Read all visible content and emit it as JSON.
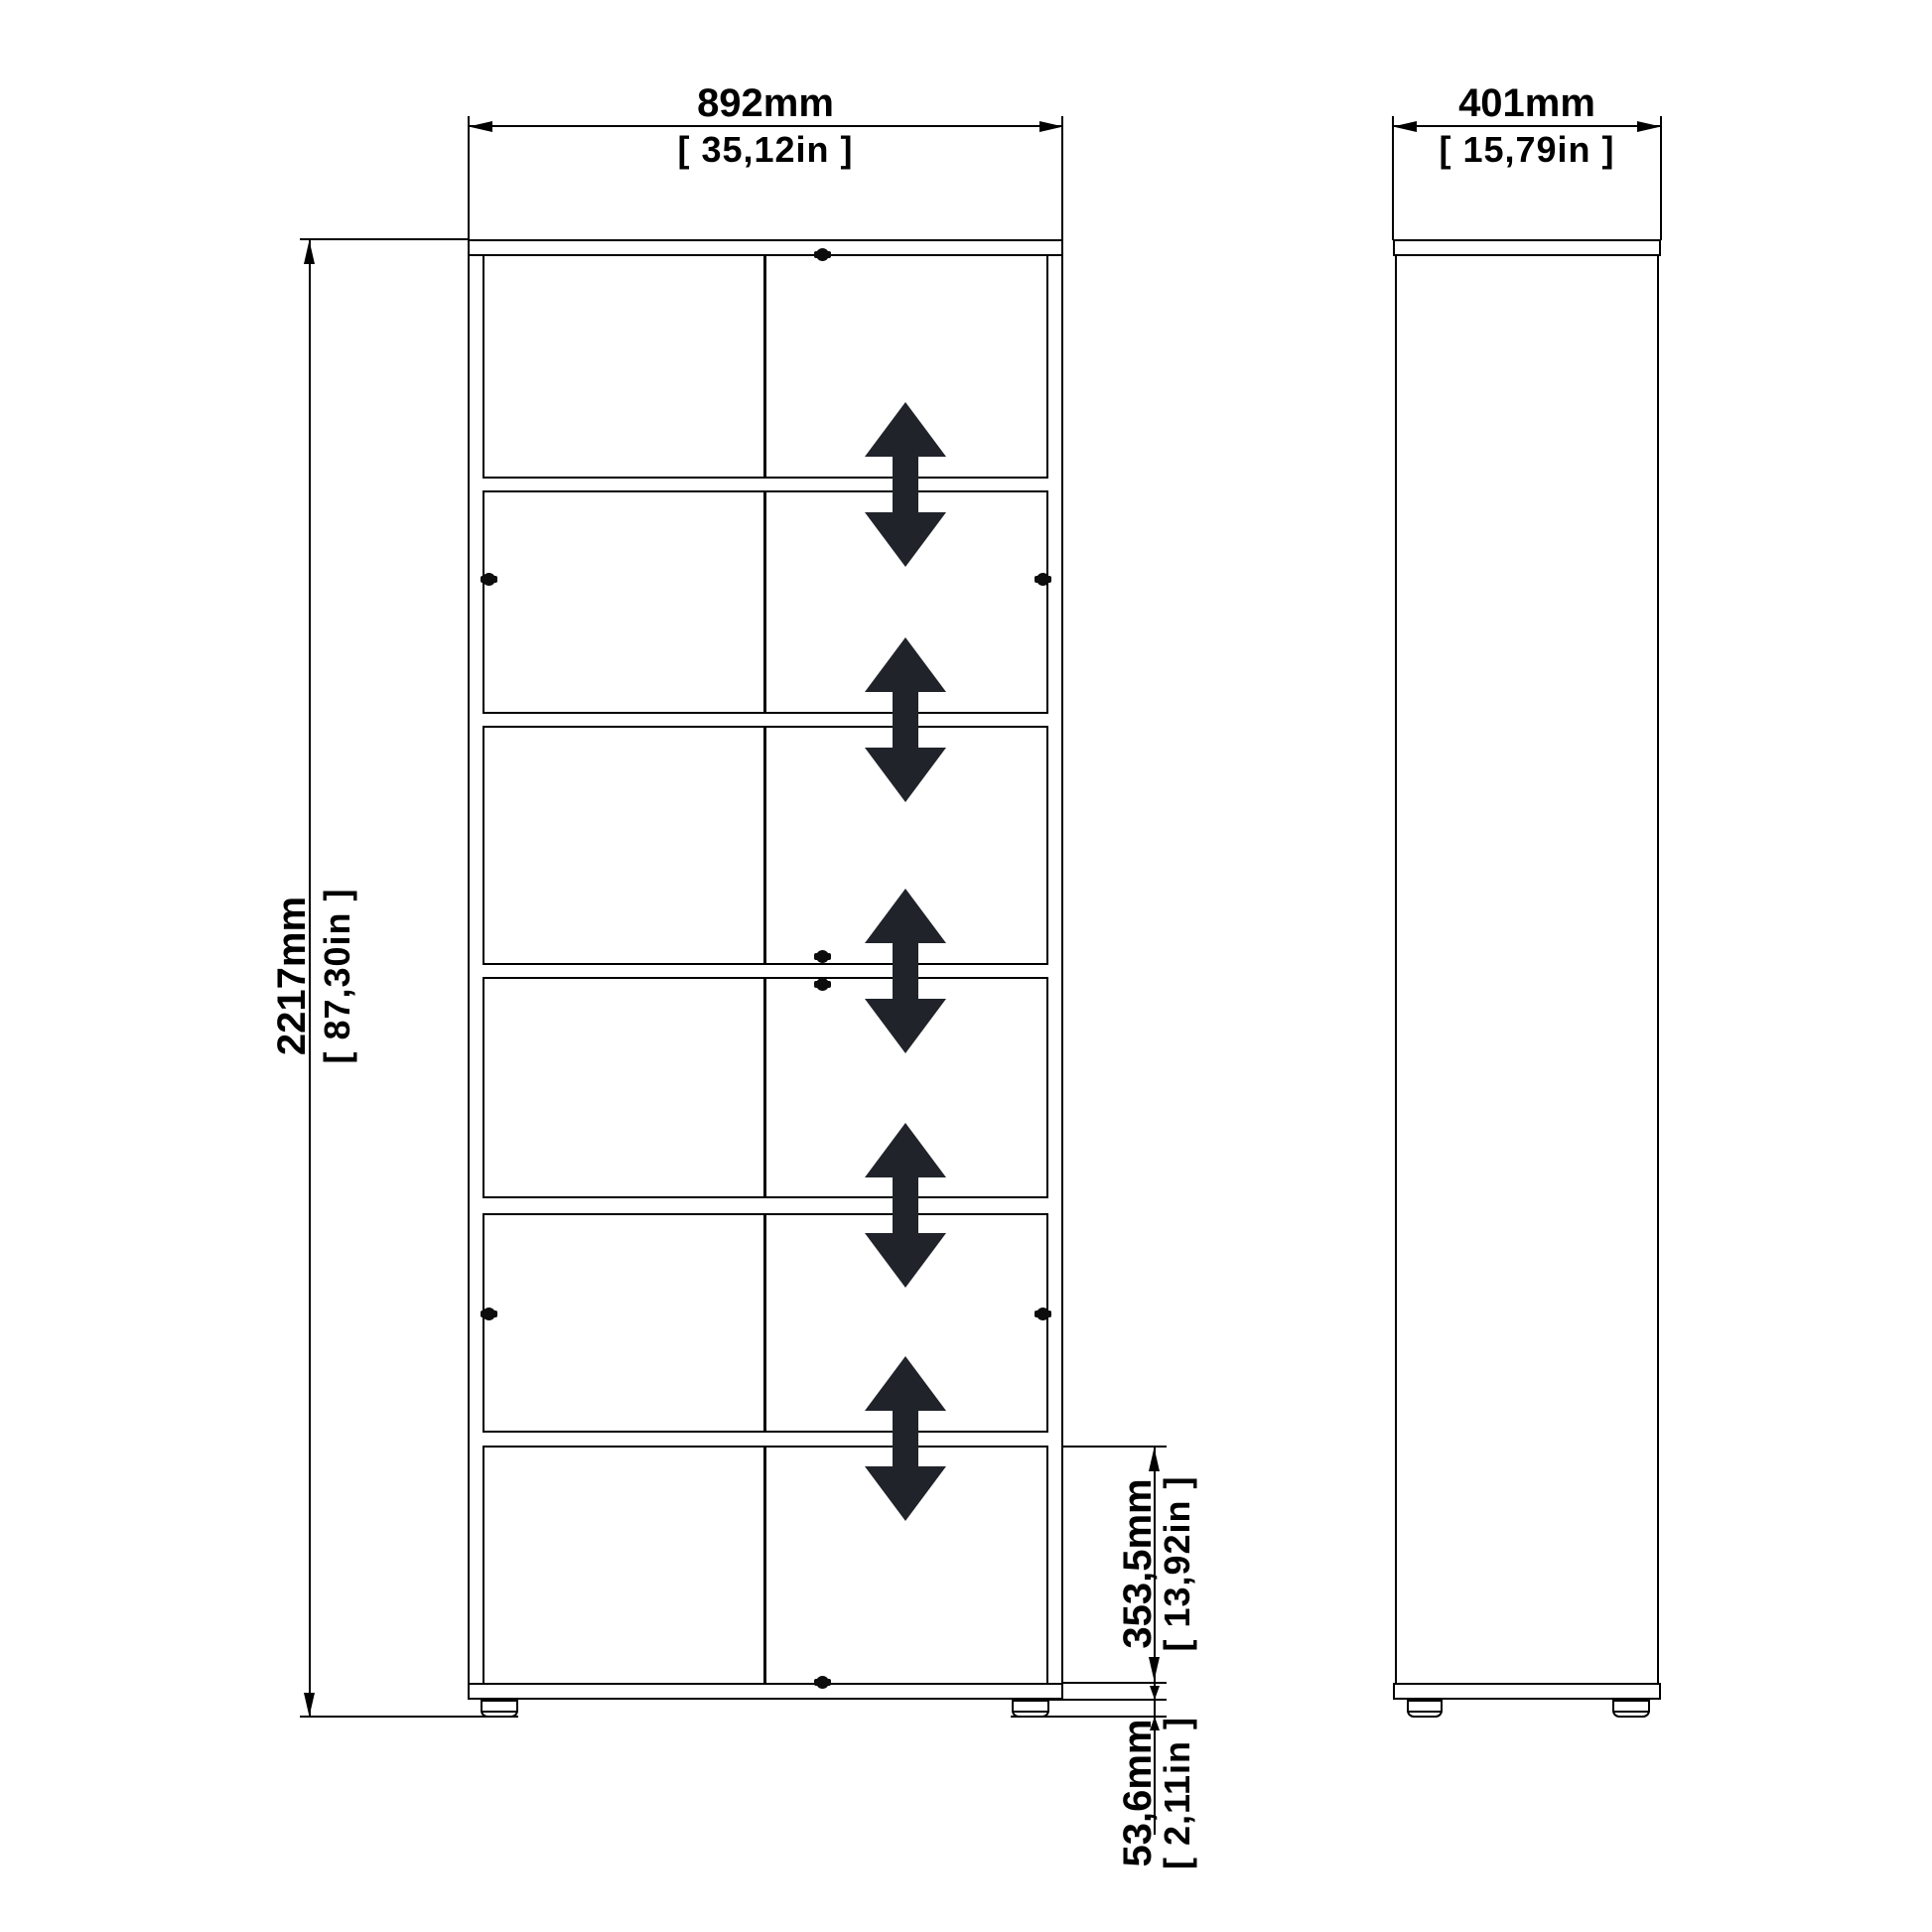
{
  "dimensions": {
    "width": {
      "mm": "892mm",
      "in": "[ 35,12in ]"
    },
    "depth": {
      "mm": "401mm",
      "in": "[ 15,79in ]"
    },
    "height": {
      "mm": "2217mm",
      "in": "[ 87,30in ]"
    },
    "shelf_clearance": {
      "mm": "353,5mm",
      "in": "[ 13,92in ]"
    },
    "plinth_height": {
      "mm": "53,6mm",
      "in": "[ 2,11in ]"
    }
  },
  "colors": {
    "outline": "#000000",
    "arrow": "#20242a",
    "background": "#ffffff"
  },
  "icons": {
    "shelf_adjust_arrow": "double-vertical-arrow",
    "fastener": "cam-screw",
    "foot": "adjustable-foot"
  }
}
